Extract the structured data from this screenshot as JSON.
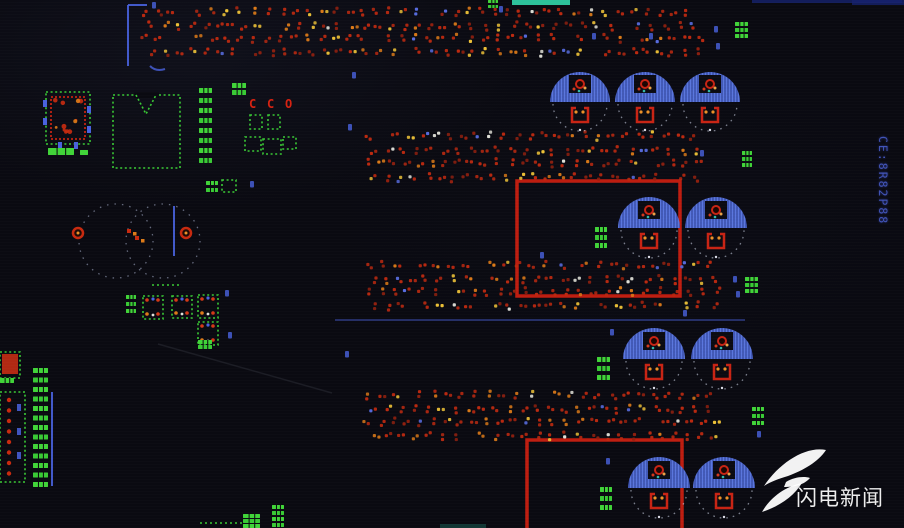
{
  "scene": {
    "watermark": {
      "text": "闪电新闻"
    },
    "vertical_label": {
      "text": "CE:8R82P88"
    }
  },
  "colors": {
    "bg": "#0a0a11",
    "silk": "#3ec83a",
    "silk_alt": "#46d23e",
    "pad_red": "#b62a12",
    "pad_red_dark": "#8f2110",
    "pad_orange": "#d97b1d",
    "pad_yellow": "#ecc23e",
    "pad_white": "#e2e2da",
    "blue": "#4a62d8",
    "cap_blue": "#5b76d8",
    "cap_hatch": "#2c3c8c",
    "outline_red": "#b81f12",
    "teal": "#35c9a2",
    "navy": "#16226a",
    "label_blue": "#4a5fd0",
    "arc_white": "rgba(215,222,240,0.55)"
  },
  "board": {
    "dot_bands": [
      {
        "x": 145,
        "y": 12,
        "w": 556,
        "rows": 4,
        "pitch_y": 13,
        "pitch_x": 13.5
      },
      {
        "x": 368,
        "y": 136,
        "w": 332,
        "rows": 4,
        "pitch_y": 13.5,
        "pitch_x": 13.5
      },
      {
        "x": 368,
        "y": 265,
        "w": 352,
        "rows": 4,
        "pitch_y": 13.3,
        "pitch_x": 13.5
      },
      {
        "x": 368,
        "y": 395,
        "w": 352,
        "rows": 4,
        "pitch_y": 13.3,
        "pitch_x": 13.5
      }
    ],
    "capacitors": [
      [
        580,
        102,
        30
      ],
      [
        645,
        102,
        30
      ],
      [
        710,
        102,
        30
      ],
      [
        649,
        228,
        31
      ],
      [
        716,
        228,
        31
      ],
      [
        654,
        359,
        31
      ],
      [
        722,
        359,
        31
      ],
      [
        659,
        488,
        31
      ],
      [
        724,
        488,
        31
      ]
    ],
    "red_rects": [
      [
        517,
        181,
        163,
        115,
        0
      ],
      [
        527,
        440,
        155,
        92,
        1
      ]
    ],
    "dashed_circles": [
      [
        116,
        241,
        37
      ],
      [
        163,
        241,
        37
      ]
    ],
    "ring_pads": [
      [
        78,
        233
      ],
      [
        186,
        233
      ]
    ],
    "red_pad_pairs": [
      [
        129,
        231
      ],
      [
        137,
        238
      ]
    ],
    "blue_lines": [
      [
        128,
        66,
        128,
        5
      ],
      [
        128,
        5,
        147,
        5
      ],
      [
        174,
        206,
        174,
        256
      ],
      [
        52,
        392,
        52,
        486
      ],
      [
        335,
        320,
        745,
        320
      ]
    ],
    "bar_stacks": [
      [
        199,
        88,
        13,
        5,
        8,
        10
      ],
      [
        33,
        368,
        15,
        5,
        13,
        9.5
      ],
      [
        735,
        22,
        13,
        4,
        3,
        6
      ],
      [
        742,
        151,
        10,
        4,
        3,
        6
      ],
      [
        745,
        277,
        13,
        4,
        3,
        6
      ],
      [
        752,
        407,
        12,
        4,
        3,
        7
      ],
      [
        595,
        227,
        12,
        5,
        3,
        8
      ],
      [
        597,
        357,
        13,
        5,
        3,
        9
      ],
      [
        600,
        487,
        12,
        5,
        3,
        9
      ],
      [
        243,
        514,
        17,
        4,
        3,
        5
      ],
      [
        272,
        505,
        12,
        4,
        4,
        6
      ],
      [
        48,
        148,
        26,
        7,
        1,
        0
      ],
      [
        80,
        150,
        8,
        5,
        1,
        0
      ],
      [
        198,
        340,
        14,
        4,
        2,
        5
      ],
      [
        488,
        0,
        10,
        3,
        2,
        5
      ],
      [
        126,
        295,
        10,
        4,
        3,
        7
      ],
      [
        232,
        83,
        14,
        5,
        2,
        7
      ],
      [
        206,
        181,
        12,
        4,
        2,
        7
      ],
      [
        0,
        378,
        14,
        5,
        1,
        0
      ]
    ],
    "outline_rects": [
      [
        46,
        92,
        44,
        52,
        0
      ],
      [
        113,
        95,
        67,
        73,
        1
      ],
      [
        143,
        296,
        20,
        23,
        2
      ],
      [
        172,
        296,
        20,
        22,
        2
      ],
      [
        198,
        295,
        20,
        23,
        2
      ],
      [
        198,
        322,
        20,
        23,
        2
      ],
      [
        0,
        392,
        25,
        90,
        3
      ],
      [
        250,
        115,
        12,
        14,
        0
      ],
      [
        268,
        115,
        12,
        14,
        0
      ],
      [
        245,
        137,
        16,
        14,
        0
      ],
      [
        263,
        139,
        18,
        15,
        0
      ],
      [
        283,
        137,
        13,
        12,
        0
      ],
      [
        222,
        180,
        14,
        12,
        0
      ],
      [
        0,
        352,
        20,
        26,
        0
      ]
    ],
    "red_fill_rects": [
      [
        2,
        354,
        16,
        20
      ]
    ],
    "ic_inner_red": [
      51,
      97,
      34,
      42
    ],
    "ic_blue_pads": [
      [
        43,
        100
      ],
      [
        43,
        118
      ],
      [
        87,
        106
      ],
      [
        87,
        126
      ],
      [
        58,
        142
      ],
      [
        74,
        142
      ]
    ],
    "green_dash_lines": [
      [
        200,
        523,
        243,
        523
      ],
      [
        152,
        285,
        180,
        285
      ]
    ],
    "specks": [
      [
        152,
        2
      ],
      [
        352,
        72
      ],
      [
        348,
        124
      ],
      [
        499,
        6
      ],
      [
        592,
        33
      ],
      [
        649,
        33
      ],
      [
        714,
        26
      ],
      [
        716,
        43
      ],
      [
        733,
        276
      ],
      [
        736,
        291
      ],
      [
        610,
        329
      ],
      [
        606,
        458
      ],
      [
        225,
        290
      ],
      [
        228,
        332
      ],
      [
        345,
        351
      ],
      [
        757,
        431
      ],
      [
        250,
        181
      ],
      [
        683,
        310
      ],
      [
        700,
        150
      ],
      [
        540,
        252
      ]
    ],
    "teal_bar": [
      512,
      0,
      58,
      5
    ],
    "navy_bars": [
      [
        752,
        0,
        150,
        3
      ],
      [
        852,
        0,
        52,
        5
      ]
    ],
    "dim_bars": [
      [
        440,
        524,
        46,
        4
      ]
    ],
    "scratch": [
      158,
      344,
      332,
      393
    ],
    "cco": {
      "chars": [
        "C",
        "C",
        "O"
      ],
      "y": 108,
      "xs": [
        249,
        267,
        285
      ]
    }
  }
}
